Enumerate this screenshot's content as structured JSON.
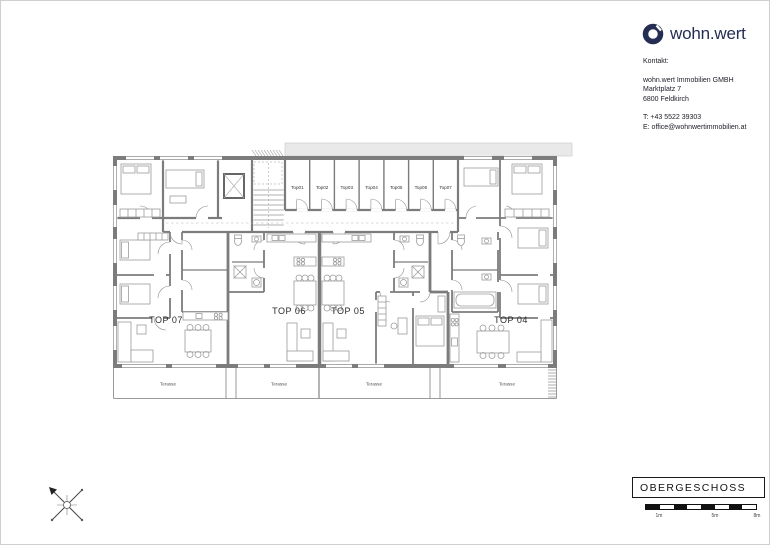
{
  "brand": {
    "logo_text": "wohn.wert"
  },
  "contact": {
    "heading": "Kontakt:",
    "lines1": [
      "wohn.wert Immobilien GMBH",
      "Marktplatz 7",
      "6800 Feldkirch"
    ],
    "lines2": [
      "T: +43 5522 39303",
      "E: office@wohnwertimmobilien.at"
    ]
  },
  "plan": {
    "apartments": [
      "TOP 07",
      "TOP 06",
      "TOP 05",
      "TOP 04"
    ],
    "storage_units": [
      "Top01",
      "Top02",
      "Top03",
      "Top04",
      "Top05",
      "Top06",
      "Top07"
    ],
    "terraces": [
      "Terasse",
      "Terasse",
      "Terasse",
      "Terasse"
    ]
  },
  "title_block": {
    "label": "OBERGESCHOSS"
  },
  "scale_bar": {
    "labels": [
      "1m",
      "5m",
      "8m"
    ]
  },
  "colors": {
    "brand_navy": "#252e52",
    "wall_gray": "#7c7c7c",
    "furniture_gray": "#9c9c9c",
    "band_gray": "#e9e9e9",
    "scalebar_black": "#111111"
  }
}
